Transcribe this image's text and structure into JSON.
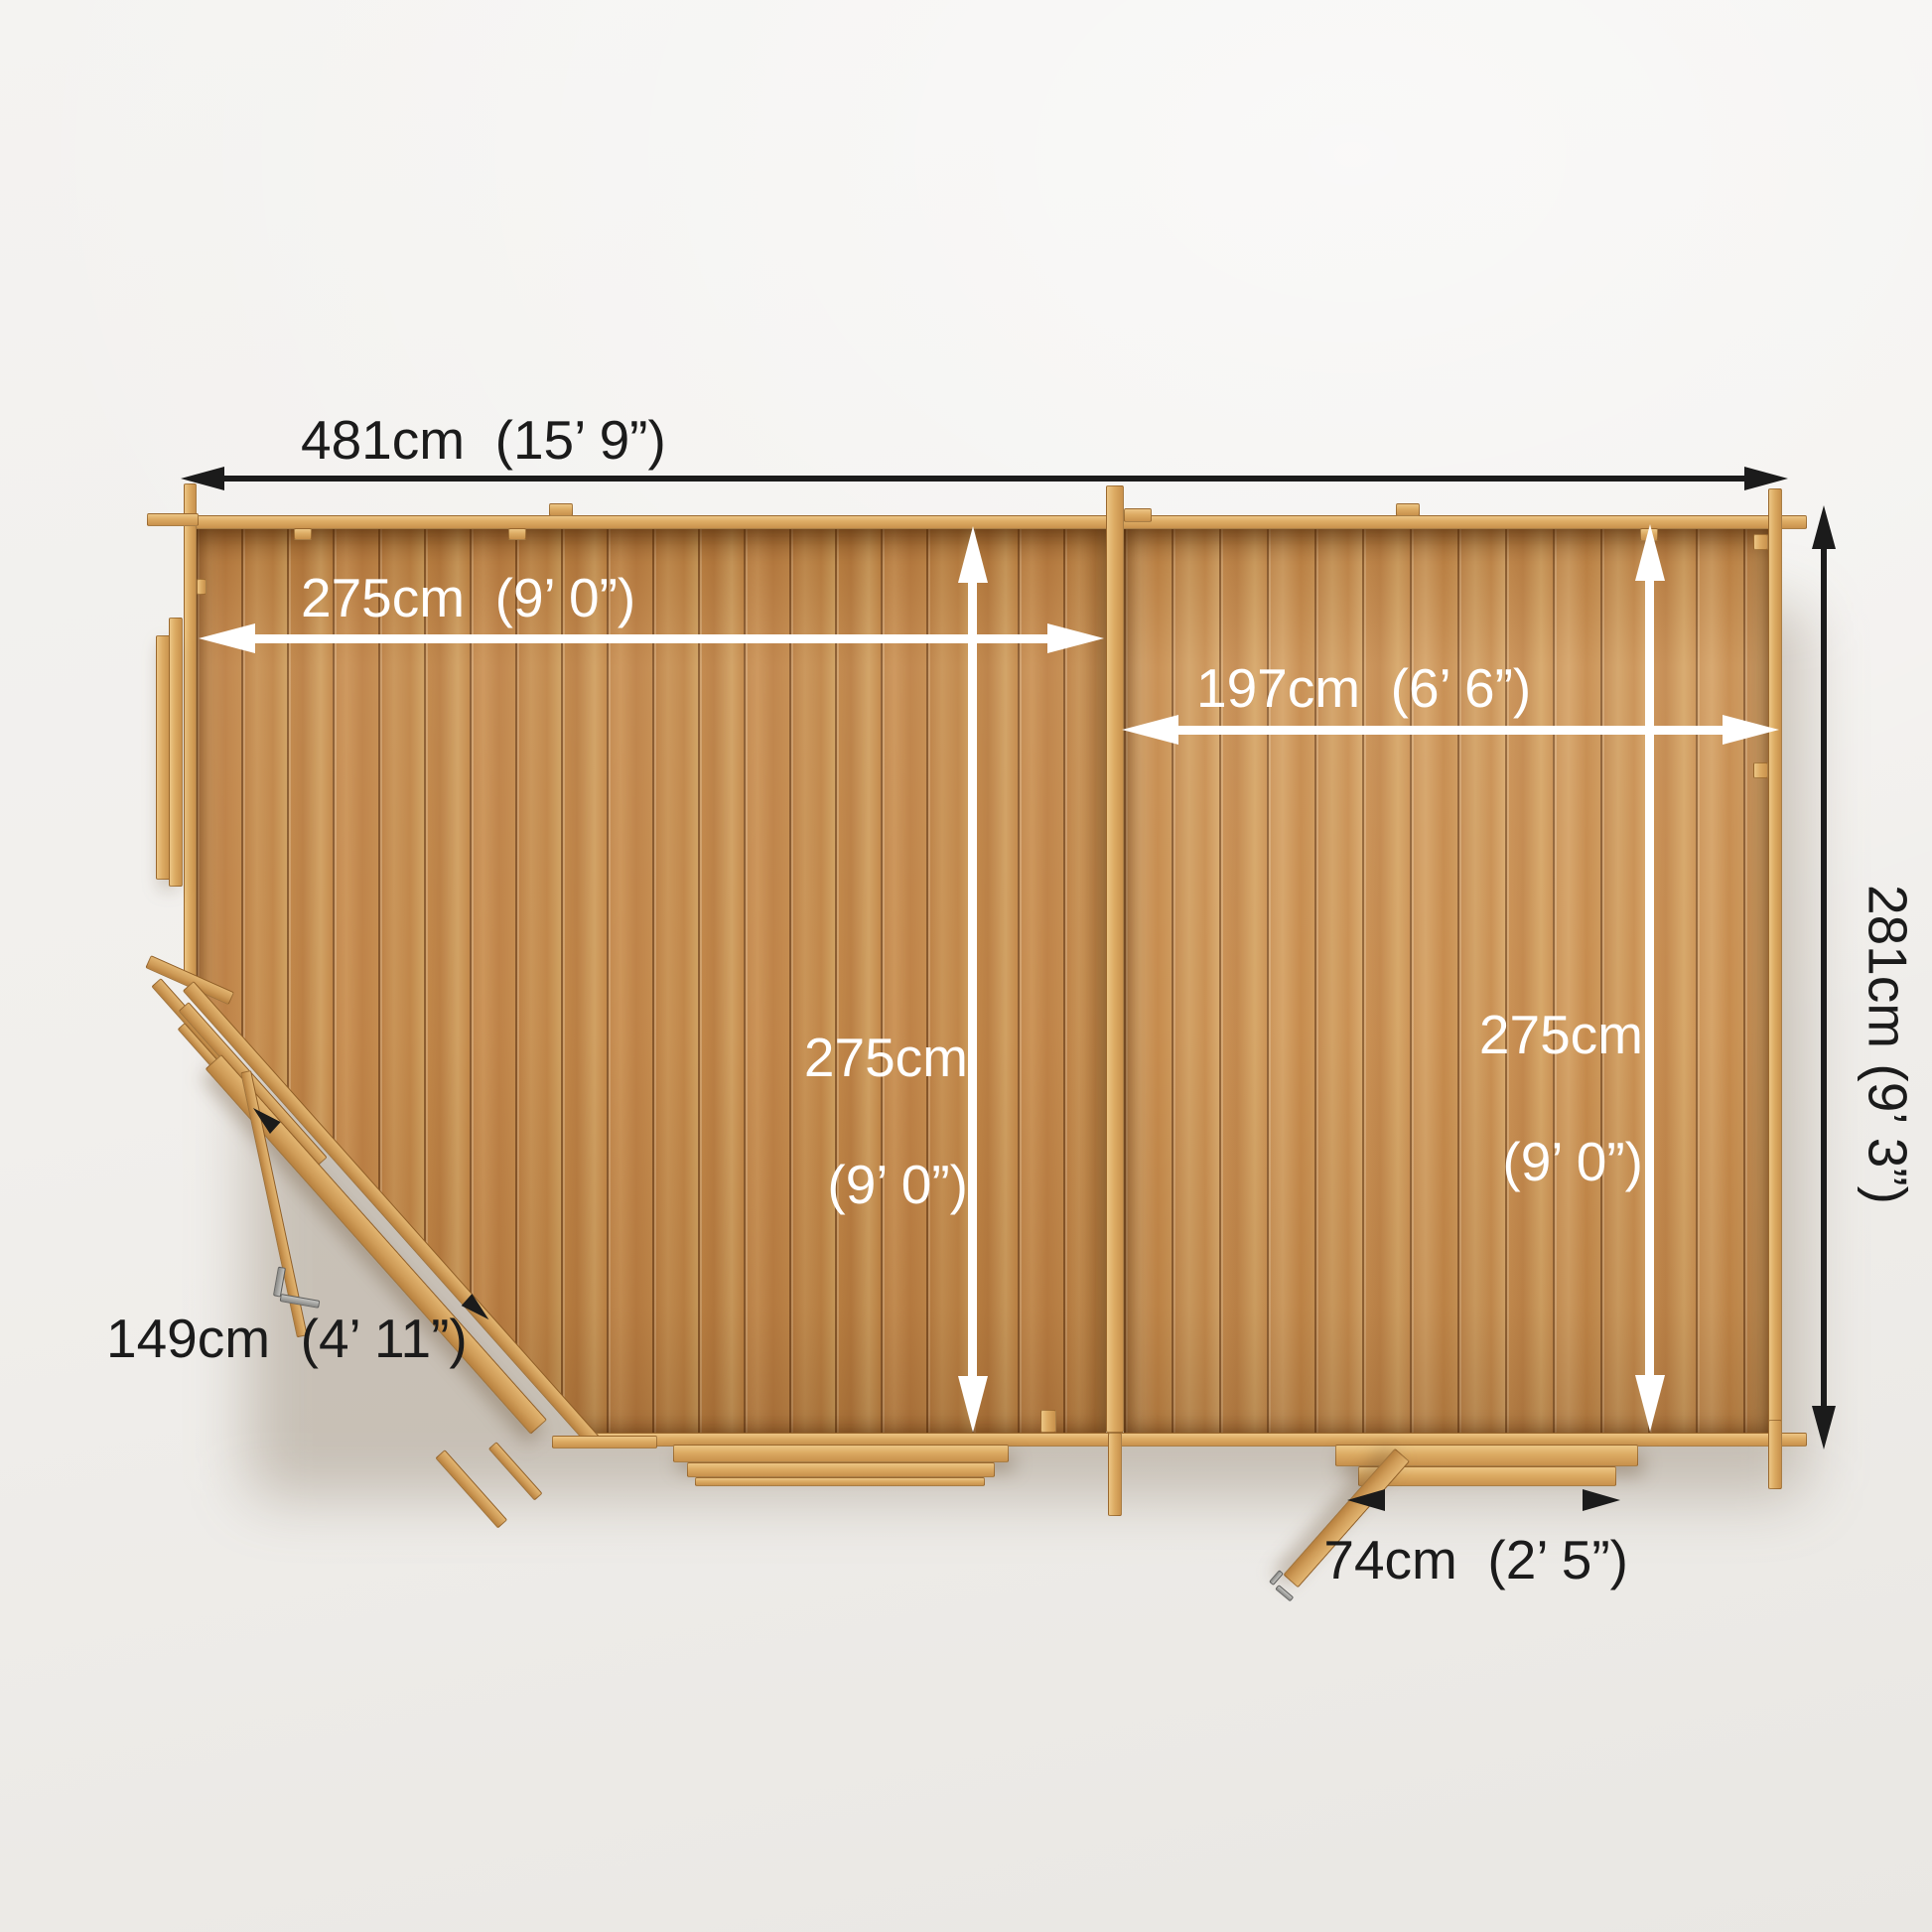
{
  "diagram": {
    "type": "floor-plan-top-view",
    "subject": "corner log cabin with two rooms, chamfered corner door, side door and left window",
    "labels": {
      "overall_width": "481cm  (15’ 9”)",
      "main_room_width": "275cm  (9’ 0”)",
      "side_room_width": "197cm  (6’ 6”)",
      "main_room_depth": [
        "275cm",
        "(9’ 0”)"
      ],
      "side_room_depth": [
        "275cm",
        "(9’ 0”)"
      ],
      "overall_depth": "281cm  (9’ 3”)",
      "corner_door_width": "149cm  (4’ 11”)",
      "side_door_width": "74cm  (2’ 5”)"
    },
    "measurements_cm": {
      "overall_width": 481,
      "main_room_width": 275,
      "side_room_width": 197,
      "main_room_depth": 275,
      "side_room_depth": 275,
      "overall_depth": 281,
      "corner_door_width": 149,
      "side_door_width": 74
    },
    "colors": {
      "background": "#f1efec",
      "floor_wood": "#c28747",
      "wall_wood": "#dcab63",
      "arrow_black": "#1b1b1b",
      "arrow_white": "#ffffff",
      "text_black": "#1b1b1b",
      "text_white": "#ffffff",
      "handle_gray": "#9a9a97"
    }
  }
}
